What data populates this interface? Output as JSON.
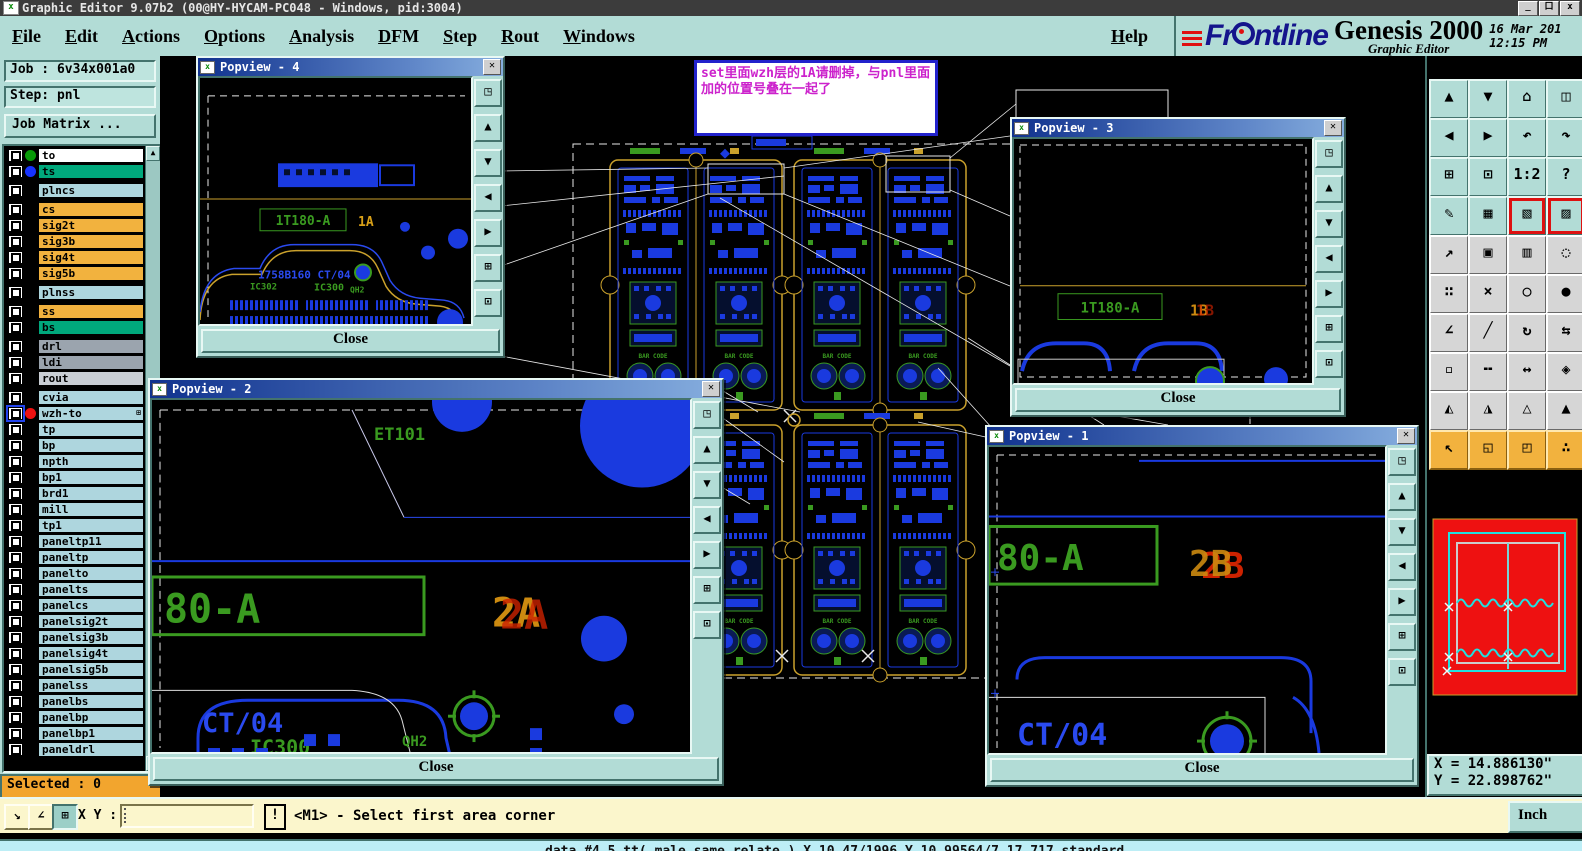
{
  "window": {
    "icon_glyph": "x",
    "title": "Graphic Editor 9.07b2 (00@HY-HYCAM-PC048 - Windows, pid:3004)",
    "min": "_",
    "max": "口",
    "close": "x"
  },
  "menu": {
    "items": [
      "File",
      "Edit",
      "Actions",
      "Options",
      "Analysis",
      "DFM",
      "Step",
      "Rout",
      "Windows"
    ],
    "help": "Help"
  },
  "brand": {
    "logo": "Frontline",
    "product": "Genesis 2000",
    "subtitle": "Graphic Editor",
    "date": "16 Mar 201",
    "time": "12:15 PM"
  },
  "sidebar": {
    "job": "Job : 6v34x001a0",
    "step": "Step: pnl",
    "job_matrix": "Job Matrix ...",
    "selected": "Selected : 0",
    "layers": [
      {
        "name": "to",
        "bg": "#ffffff",
        "dot": "#089a08"
      },
      {
        "name": "ts",
        "bg": "#00a87c",
        "dot": "#1632ff"
      },
      {
        "name": "plncs",
        "bg": "#aed6de",
        "gap": true
      },
      {
        "name": "cs",
        "bg": "#f2b23e",
        "gap": true
      },
      {
        "name": "sig2t",
        "bg": "#f2b23e"
      },
      {
        "name": "sig3b",
        "bg": "#f2b23e"
      },
      {
        "name": "sig4t",
        "bg": "#f2b23e"
      },
      {
        "name": "sig5b",
        "bg": "#f2b23e"
      },
      {
        "name": "plnss",
        "bg": "#aed6de",
        "gap": true
      },
      {
        "name": "ss",
        "bg": "#f2b23e",
        "gap": true
      },
      {
        "name": "bs",
        "bg": "#00a87c"
      },
      {
        "name": "drl",
        "bg": "#9ba4ae",
        "gap": true
      },
      {
        "name": "ldi",
        "bg": "#9ba4ae"
      },
      {
        "name": "rout",
        "bg": "#c9ced4"
      },
      {
        "name": "cvia",
        "bg": "#aed6de",
        "gap": true
      },
      {
        "name": "wzh-to",
        "bg": "#aed6de",
        "dot": "#ee1111",
        "selected": true,
        "badge": "⊞"
      },
      {
        "name": "tp",
        "bg": "#aed6de"
      },
      {
        "name": "bp",
        "bg": "#aed6de"
      },
      {
        "name": "npth",
        "bg": "#aed6de"
      },
      {
        "name": "bp1",
        "bg": "#aed6de"
      },
      {
        "name": "brd1",
        "bg": "#aed6de"
      },
      {
        "name": "mill",
        "bg": "#aed6de"
      },
      {
        "name": "tp1",
        "bg": "#aed6de"
      },
      {
        "name": "paneltp11",
        "bg": "#aed6de"
      },
      {
        "name": "paneltp",
        "bg": "#aed6de"
      },
      {
        "name": "panelto",
        "bg": "#aed6de"
      },
      {
        "name": "panelts",
        "bg": "#aed6de"
      },
      {
        "name": "panelcs",
        "bg": "#aed6de"
      },
      {
        "name": "panelsig2t",
        "bg": "#aed6de"
      },
      {
        "name": "panelsig3b",
        "bg": "#aed6de"
      },
      {
        "name": "panelsig4t",
        "bg": "#aed6de"
      },
      {
        "name": "panelsig5b",
        "bg": "#aed6de"
      },
      {
        "name": "panelss",
        "bg": "#aed6de"
      },
      {
        "name": "panelbs",
        "bg": "#aed6de"
      },
      {
        "name": "panelbp",
        "bg": "#aed6de"
      },
      {
        "name": "panelbp1",
        "bg": "#aed6de"
      },
      {
        "name": "paneldrl",
        "bg": "#aed6de"
      }
    ]
  },
  "annotation": {
    "text": "set里面wzh层的1A请删掉，与pnl里面加的位置号叠在一起了"
  },
  "board": {
    "barcode": "BAR CODE"
  },
  "popviews": {
    "close": "Close",
    "buttons": [
      {
        "name": "popout",
        "glyph": "◳"
      },
      {
        "name": "zoom-in",
        "glyph": "▲"
      },
      {
        "name": "zoom-out",
        "glyph": "▼"
      },
      {
        "name": "pan-left",
        "glyph": "◀"
      },
      {
        "name": "pan-right",
        "glyph": "▶"
      },
      {
        "name": "fit-view",
        "glyph": "⊞"
      },
      {
        "name": "center-view",
        "glyph": "⊡"
      }
    ],
    "pv4": {
      "title": "Popview - 4",
      "ref": "1T180-A",
      "pos": "1A",
      "part": "1758B160 CT/04",
      "ic1": "IC302",
      "ic2": "IC300",
      "qh": "QH2"
    },
    "pv3": {
      "title": "Popview - 3",
      "ref": "1T180-A",
      "pos": "1B"
    },
    "pv2": {
      "title": "Popview - 2",
      "et": "ET101",
      "ref": "80-A",
      "pos": "2A",
      "ct": "CT/04",
      "ic": "IC300",
      "qh": "QH2"
    },
    "pv1": {
      "title": "Popview - 1",
      "ref": "80-A",
      "pos": "2B",
      "ct": "CT/04"
    }
  },
  "toolbar": {
    "buttons": [
      {
        "name": "view-zoom-in",
        "glyph": "▲",
        "style": "teal"
      },
      {
        "name": "view-zoom-out",
        "glyph": "▼",
        "style": "teal"
      },
      {
        "name": "home-view",
        "glyph": "⌂",
        "style": "teal"
      },
      {
        "name": "split-view",
        "glyph": "◫",
        "style": "teal"
      },
      {
        "name": "pan-left",
        "glyph": "◀",
        "style": "teal"
      },
      {
        "name": "pan-right",
        "glyph": "▶",
        "style": "teal"
      },
      {
        "name": "previous-view",
        "glyph": "↶",
        "style": "teal"
      },
      {
        "name": "next-view",
        "glyph": "↷",
        "style": "teal"
      },
      {
        "name": "fit-all",
        "glyph": "⊞",
        "style": "teal"
      },
      {
        "name": "center-view",
        "glyph": "⊡",
        "style": "teal"
      },
      {
        "name": "zoom-ratio-1-2",
        "glyph": "1:2",
        "style": "teal"
      },
      {
        "name": "context-help",
        "glyph": "?",
        "style": "teal"
      },
      {
        "name": "setup-tools",
        "glyph": "✎",
        "style": "teal"
      },
      {
        "name": "grid-toggle",
        "glyph": "▦",
        "style": "teal"
      },
      {
        "name": "layer-stoplight",
        "glyph": "▧",
        "style": "teal",
        "red": true
      },
      {
        "name": "layer-display",
        "glyph": "▨",
        "style": "teal",
        "red": true
      },
      {
        "name": "transform-mode",
        "glyph": "↗",
        "style": "gray"
      },
      {
        "name": "copy-frame",
        "glyph": "▣",
        "style": "gray"
      },
      {
        "name": "measure-ruler",
        "glyph": "▥",
        "style": "gray"
      },
      {
        "name": "select-area",
        "glyph": "◌",
        "style": "gray"
      },
      {
        "name": "net-nodes",
        "glyph": "∷",
        "style": "gray"
      },
      {
        "name": "delete-mode",
        "glyph": "×",
        "style": "gray"
      },
      {
        "name": "move-point",
        "glyph": "○",
        "style": "gray"
      },
      {
        "name": "copy-point",
        "glyph": "●",
        "style": "gray"
      },
      {
        "name": "angle-mode",
        "glyph": "∠",
        "style": "gray"
      },
      {
        "name": "line-mode",
        "glyph": "╱",
        "style": "gray"
      },
      {
        "name": "rotate-mode",
        "glyph": "↻",
        "style": "gray"
      },
      {
        "name": "mirror-mode",
        "glyph": "⇆",
        "style": "gray"
      },
      {
        "name": "pad-mode",
        "glyph": "▫",
        "style": "gray"
      },
      {
        "name": "width-mode",
        "glyph": "╍",
        "style": "gray"
      },
      {
        "name": "gap-measure",
        "glyph": "↔",
        "style": "gray"
      },
      {
        "name": "shape-mode",
        "glyph": "◈",
        "style": "gray"
      },
      {
        "name": "move-up-a",
        "glyph": "◭",
        "style": "gray"
      },
      {
        "name": "move-up-b",
        "glyph": "◮",
        "style": "gray"
      },
      {
        "name": "move-up-c",
        "glyph": "△",
        "style": "gray"
      },
      {
        "name": "move-up-d",
        "glyph": "▲",
        "style": "gray"
      },
      {
        "name": "select-pointer",
        "glyph": "↖",
        "style": "orange"
      },
      {
        "name": "select-rectangle",
        "glyph": "◱",
        "style": "orange"
      },
      {
        "name": "select-polygon",
        "glyph": "◰",
        "style": "orange"
      },
      {
        "name": "select-reference",
        "glyph": "∴",
        "style": "orange"
      }
    ]
  },
  "coords": {
    "x": "X = 14.886130\"",
    "y": "Y = 22.898762\""
  },
  "statusbar": {
    "xy_label": "X Y :",
    "input_value": "",
    "alert": "!",
    "message": "<M1> - Select first area corner",
    "unit": "Inch"
  },
  "bottom_strip": {
    "text": "data #4 5 tt( male same relate ) X 10.47/1996 Y 10.99564/7.17 717 standard"
  }
}
